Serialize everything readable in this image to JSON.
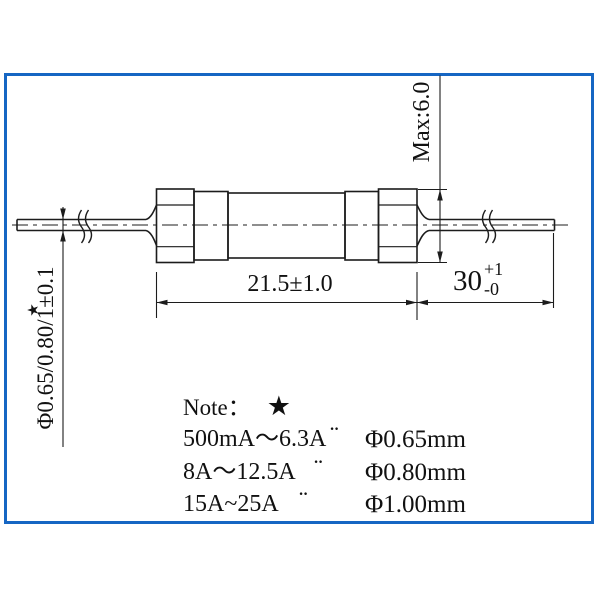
{
  "frame": {
    "border_color": "#1666c3"
  },
  "drawing": {
    "line_color": "#1c1c1c",
    "dimensions": {
      "cap_diameter": "Max:6.0",
      "body_length": "21.5±1.0",
      "lead_length": {
        "base": "30",
        "plus": "+1",
        "minus": "-0"
      },
      "lead_diameter": "Φ0.65/0.80/1±0.1",
      "lead_diameter_star": "★"
    }
  },
  "note": {
    "title": "Note：",
    "star": "★",
    "rows": [
      {
        "range": "500mA～6.3A",
        "ditto": "¨",
        "diameter": "Φ0.65mm"
      },
      {
        "range": "8A～12.5A",
        "ditto": "¨",
        "diameter": "Φ0.80mm"
      },
      {
        "range": "15A~25A",
        "ditto": "¨",
        "diameter": "Φ1.00mm"
      }
    ]
  }
}
